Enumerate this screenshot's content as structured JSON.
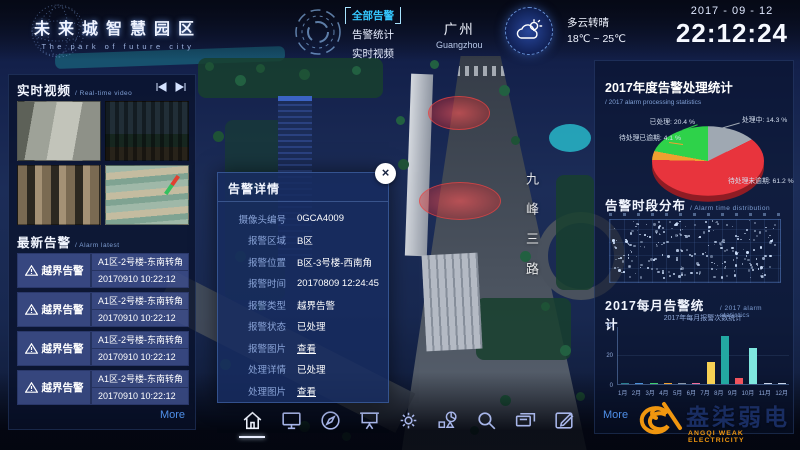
{
  "header": {
    "title": "未来城智慧园区",
    "subtitle": "The park of future city",
    "menu": [
      {
        "label": "全部告警",
        "active": true
      },
      {
        "label": "告警统计",
        "active": false
      },
      {
        "label": "实时视频",
        "active": false
      }
    ],
    "city": {
      "cn": "广州",
      "en": "Guangzhou"
    },
    "weather": {
      "condition": "多云转晴",
      "temp_range": "18℃ ~ 25℃"
    },
    "date": "2017 - 09 - 12",
    "time": "22:12:24"
  },
  "video_panel": {
    "title": "实时视频",
    "subtitle": "/ Real-time video"
  },
  "alarm_panel": {
    "title": "最新告警",
    "subtitle": "/ Alarm latest",
    "more_label": "More",
    "items": [
      {
        "type": "越界告警",
        "location": "A1区-2号楼-东南转角",
        "time": "20170910 10:22:12"
      },
      {
        "type": "越界告警",
        "location": "A1区-2号楼-东南转角",
        "time": "20170910 10:22:12"
      },
      {
        "type": "越界告警",
        "location": "A1区-2号楼-东南转角",
        "time": "20170910 10:22:12"
      },
      {
        "type": "越界告警",
        "location": "A1区-2号楼-东南转角",
        "time": "20170910 10:22:12"
      }
    ]
  },
  "modal": {
    "title": "告警详情",
    "close_glyph": "×",
    "fields": [
      {
        "label": "摄像头编号",
        "value": "0GCA4009",
        "link": false
      },
      {
        "label": "报警区域",
        "value": "B区",
        "link": false
      },
      {
        "label": "报警位置",
        "value": "B区-3号楼-西南角",
        "link": false
      },
      {
        "label": "报警时间",
        "value": "20170809 12:24:45",
        "link": false
      },
      {
        "label": "报警类型",
        "value": "越界告警",
        "link": false
      },
      {
        "label": "报警状态",
        "value": "已处理",
        "link": false
      },
      {
        "label": "报警图片",
        "value": "查看",
        "link": true
      },
      {
        "label": "处理详情",
        "value": "已处理",
        "link": false
      },
      {
        "label": "处理图片",
        "value": "查看",
        "link": true
      }
    ]
  },
  "map": {
    "road_label": "九峰三路"
  },
  "right_panel": {
    "pie_title": "2017年度告警处理统计",
    "pie_subtitle": "/ 2017 alarm processing statistics",
    "scatter_title": "告警时段分布",
    "scatter_subtitle": "/ Alarm time distribution",
    "bar_title": "2017每月告警统计",
    "bar_subtitle": "/ 2017 alarm statistics",
    "more_label": "More"
  },
  "chart_data": [
    {
      "type": "pie",
      "title": "2017年度告警处理统计",
      "subtitle": "/ 2017 alarm processing statistics",
      "unit": "%",
      "slices": [
        {
          "label": "处理中",
          "value": 14.3,
          "color": "#9fa8b2"
        },
        {
          "label": "待处理未逾期",
          "value": 61.2,
          "color": "#e8343d"
        },
        {
          "label": "待处理已逾期",
          "value": 4.1,
          "color": "#f0a030"
        },
        {
          "label": "已处理",
          "value": 20.4,
          "color": "#2ed24a"
        }
      ]
    },
    {
      "type": "scatter",
      "title": "告警时段分布",
      "subtitle": "/ Alarm time distribution",
      "note": "dense unlabeled dot field of alarm occurrences by time",
      "point_count": 230,
      "dot_color": "#d2e4ff"
    },
    {
      "type": "bar",
      "title": "2017每月告警统计",
      "subtitle": "/ 2017 alarm statistics",
      "inner_title": "2017年每月报警次数统计",
      "categories": [
        "1月",
        "2月",
        "3月",
        "4月",
        "5月",
        "6月",
        "7月",
        "8月",
        "9月",
        "10月",
        "11月",
        "12月"
      ],
      "values": [
        1,
        1,
        1,
        1,
        1,
        1,
        15,
        33,
        4,
        25,
        0.5,
        0.5
      ],
      "colors": [
        "#2a7f8f",
        "#4a90d9",
        "#3ecf6e",
        "#f0a030",
        "#8a97a8",
        "#f26d9a",
        "#f7d154",
        "#23a8a2",
        "#f0545e",
        "#7fe8df",
        "#c8d4e8",
        "#c8d4e8"
      ],
      "ylim": [
        0,
        40
      ],
      "yticks": [
        0,
        20,
        40
      ],
      "grid": true,
      "legend": false
    }
  ],
  "toolbar": {
    "icons": [
      {
        "name": "home",
        "active": true
      },
      {
        "name": "monitor",
        "active": false
      },
      {
        "name": "compass",
        "active": false
      },
      {
        "name": "presentation",
        "active": false
      },
      {
        "name": "settings",
        "active": false
      },
      {
        "name": "statistics",
        "active": false
      },
      {
        "name": "search",
        "active": false
      },
      {
        "name": "records",
        "active": false
      },
      {
        "name": "edit",
        "active": false
      }
    ]
  },
  "branding": {
    "logo_cn": "盎柒弱电",
    "logo_en": "ANGQI WEAK ELECTRICITY"
  }
}
